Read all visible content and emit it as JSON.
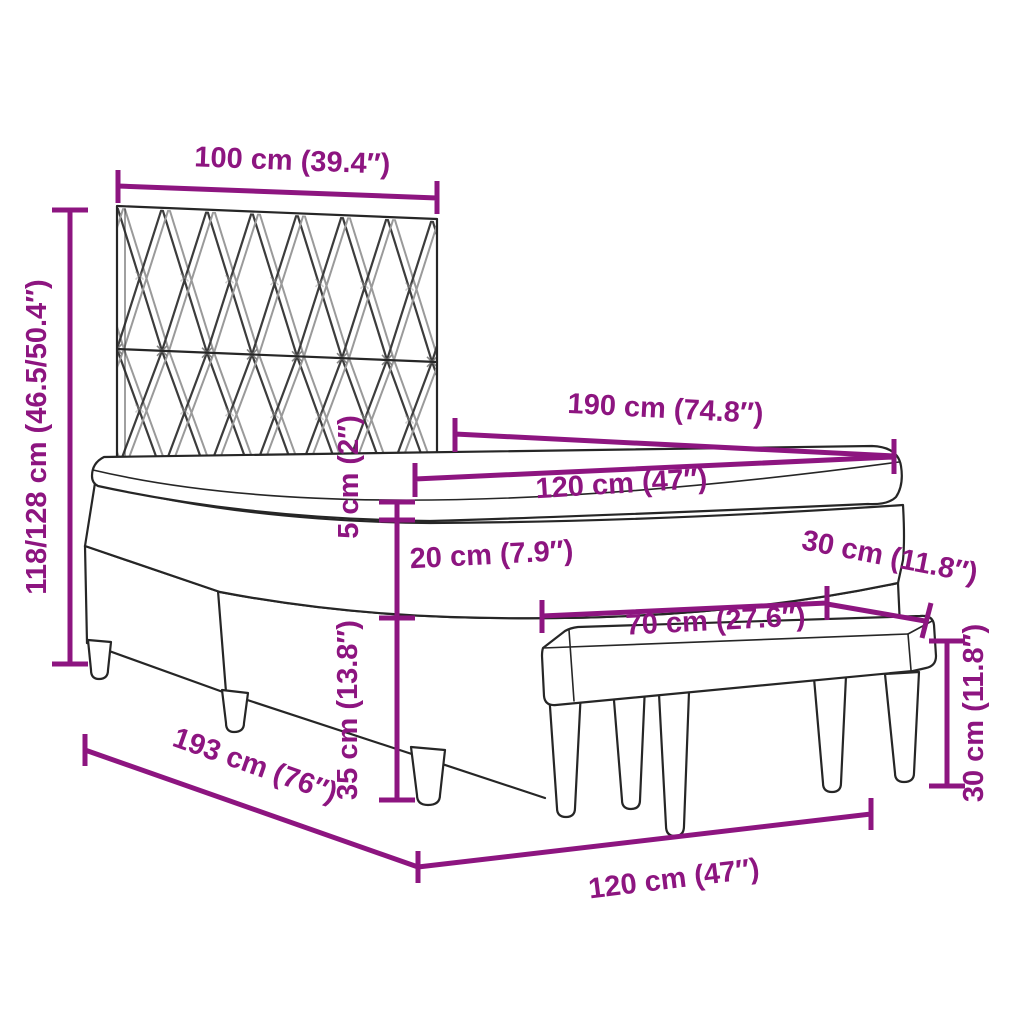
{
  "diagram_type": "furniture-dimension-diagram",
  "subject": "box spring bed with patterned headboard, mattress, topper and upholstered bench",
  "accent_color": "#8D1580",
  "line_color": "#262626",
  "dimensions": {
    "headboard_width": "100 cm (39.4″)",
    "total_height": "118/128 cm (46.5/50.4″)",
    "mattress_length": "190 cm (74.8″)",
    "mattress_width": "120 cm (47″)",
    "topper_height": "5 cm (2″)",
    "mattress_height": "20 cm (7.9″)",
    "base_height": "35 cm (13.8″)",
    "bench_length": "70 cm (27.6″)",
    "bench_depth": "30 cm (11.8″)",
    "bench_height": "30 cm (11.8″)",
    "base_length": "193 cm (76″)",
    "bed_width": "120 cm (47″)"
  }
}
